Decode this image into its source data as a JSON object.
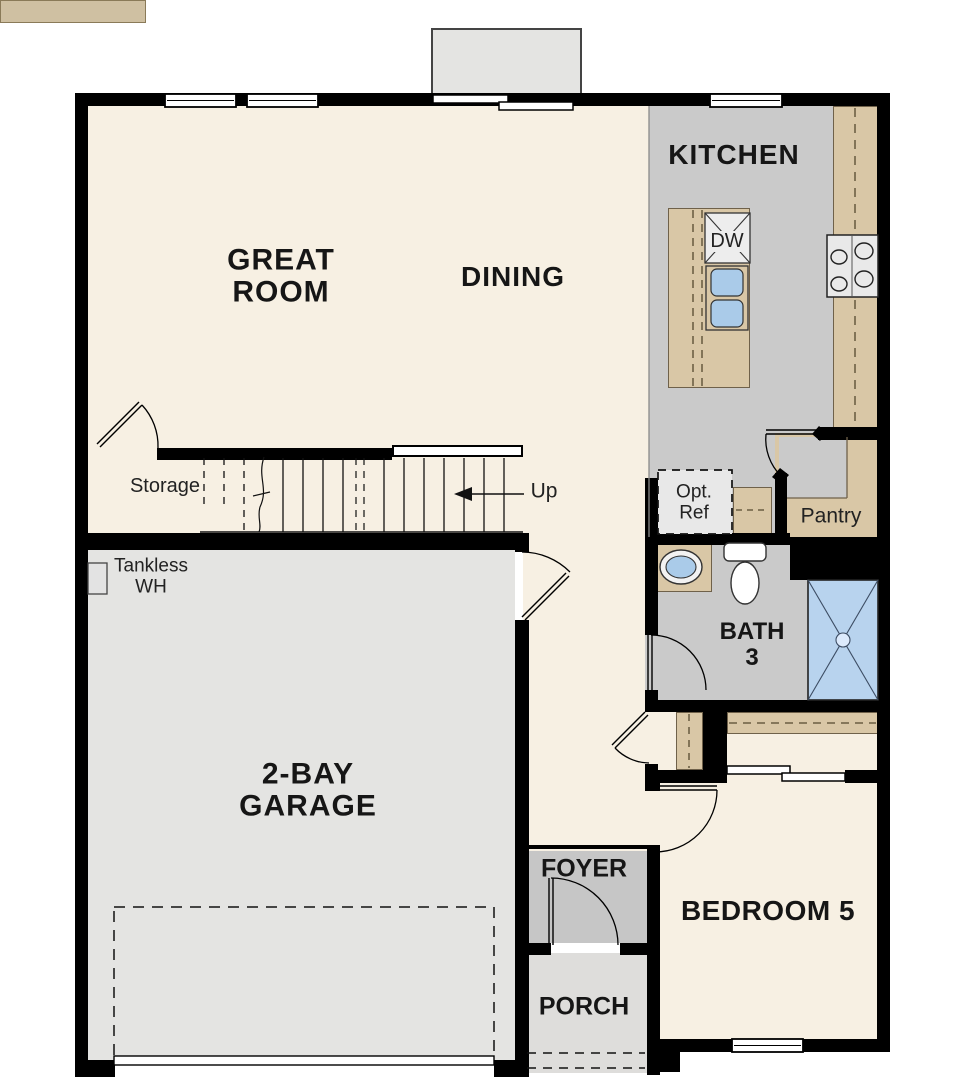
{
  "rooms": {
    "great_room": {
      "label": "GREAT\nROOM"
    },
    "dining": {
      "label": "DINING"
    },
    "kitchen": {
      "label": "KITCHEN"
    },
    "garage": {
      "label": "2-BAY\nGARAGE"
    },
    "bedroom5": {
      "label": "BEDROOM 5"
    },
    "foyer": {
      "label": "FOYER"
    },
    "porch": {
      "label": "PORCH"
    },
    "bath3": {
      "label": "BATH\n3"
    },
    "pantry": {
      "label": "Pantry"
    },
    "storage": {
      "label": "Storage"
    }
  },
  "annotations": {
    "up": {
      "label": "Up"
    },
    "tankless_wh": {
      "label": "Tankless\nWH"
    },
    "opt_ref": {
      "label": "Opt.\nRef"
    },
    "dishwasher": {
      "label": "DW"
    }
  },
  "fixtures": [
    "kitchen-island",
    "dishwasher",
    "double-basin-sink",
    "cooktop",
    "optional-refrigerator",
    "pantry-shelves",
    "vanity-sink",
    "toilet",
    "shower",
    "tankless-water-heater",
    "storage-shelf",
    "stairs-up",
    "sliding-glass-door",
    "garage-overhead-door",
    "entry-door",
    "closet-sliding-doors",
    "windows"
  ],
  "colors": {
    "wall": "#000000",
    "floor_main": "#f7f0e3",
    "floor_kitchen_bath": "#cacaca",
    "floor_garage": "#e4e4e2",
    "floor_foyer": "#c6c6c6",
    "floor_porch": "#dedddb",
    "counter_tan": "#d9c7a6",
    "shelf_tan": "#cfc0a2",
    "fixture_blue": "#aacbe9",
    "shower_blue": "#b8d3ee"
  }
}
